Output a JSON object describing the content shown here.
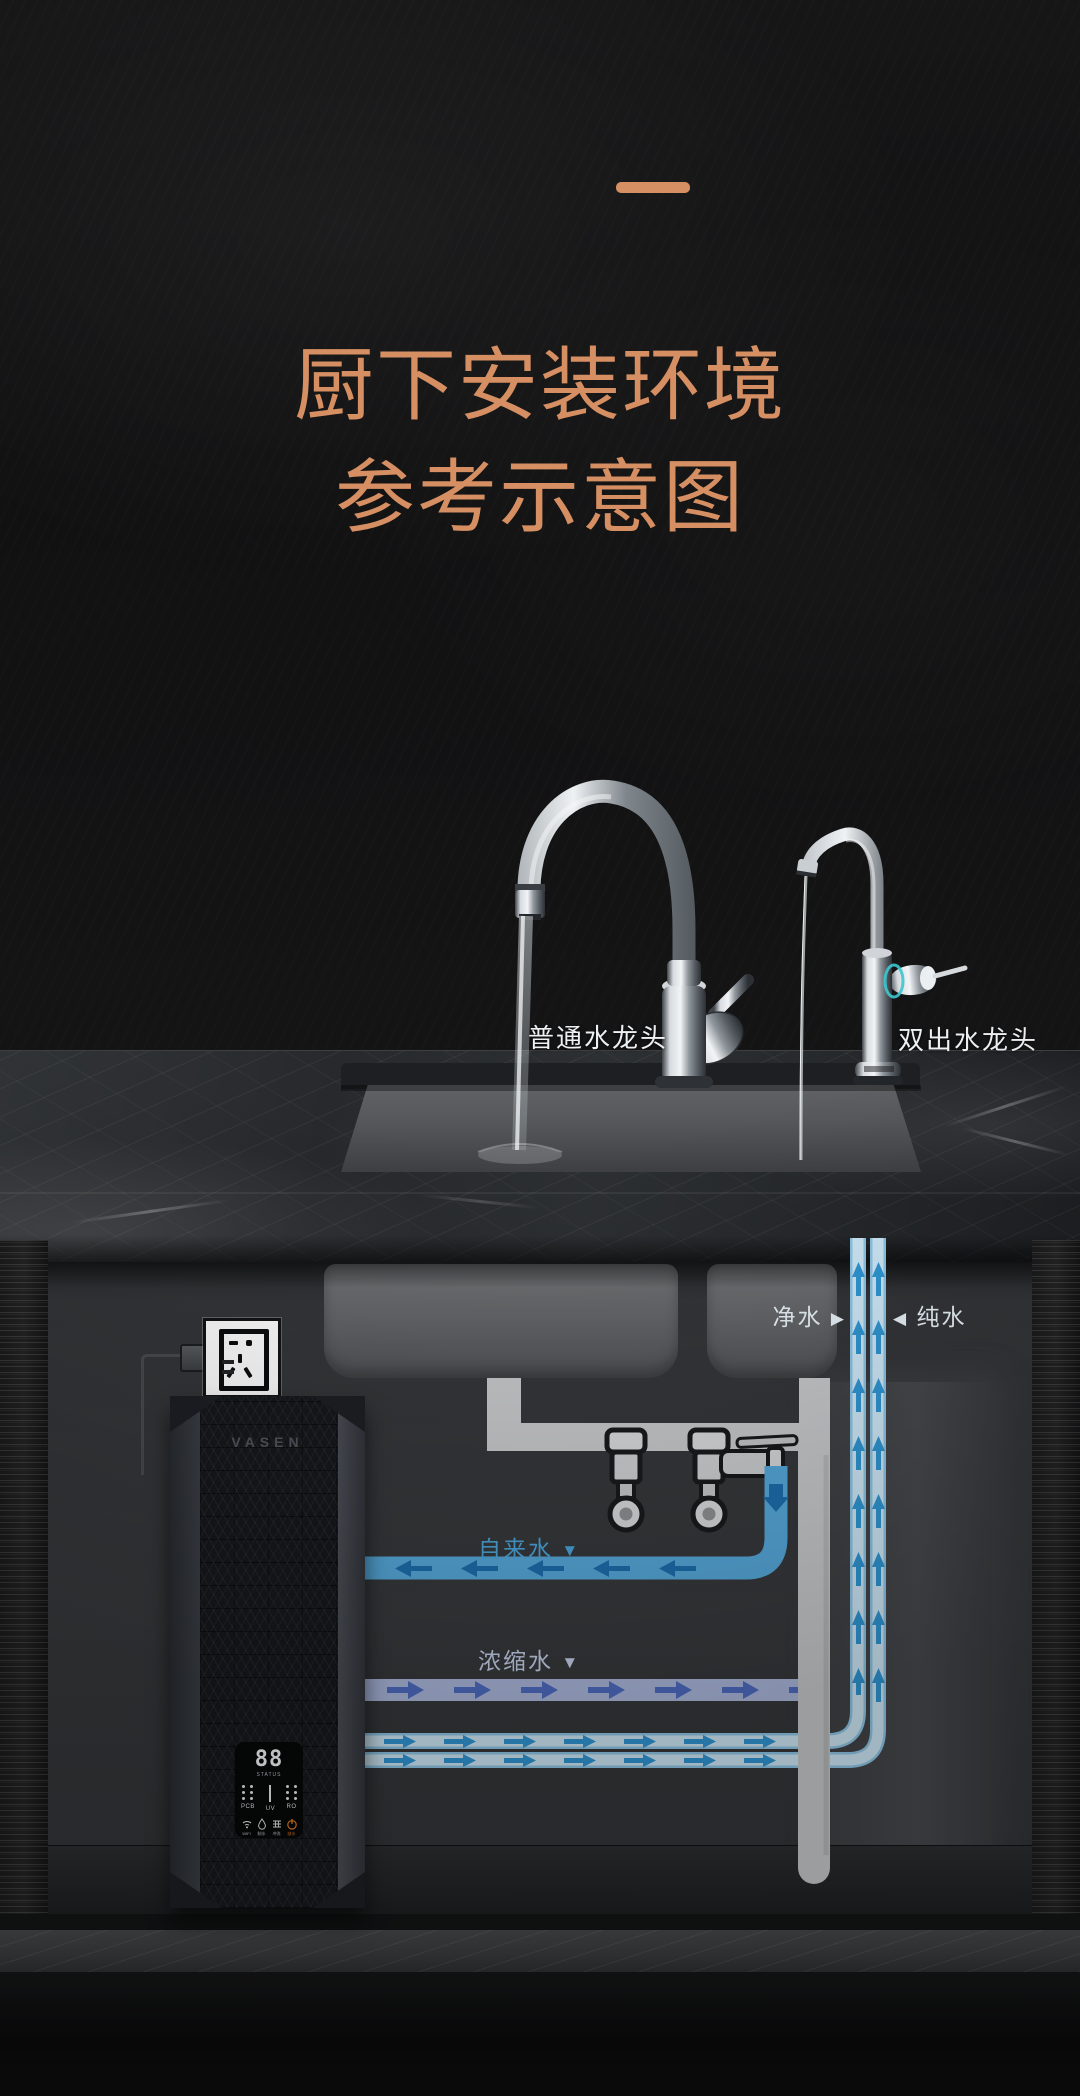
{
  "header": {
    "title_line1": "厨下安装环境",
    "title_line2": "参考示意图",
    "accent_color": "#d68f62"
  },
  "scene": {
    "left_faucet_label": "普通水龙头",
    "right_faucet_label": "双出水龙头"
  },
  "diagram": {
    "flow_labels": {
      "purified": "净水",
      "purified_arrow": "▶",
      "pure": "纯水",
      "pure_arrow": "◀",
      "tap": "自来水",
      "tap_arrow": "▼",
      "concentrate": "浓缩水",
      "concentrate_arrow": "▼"
    },
    "purifier": {
      "brand": "VASEN",
      "display": {
        "digits": "88",
        "caption": "STATUS",
        "indicators": [
          "PCB",
          "UV",
          "RO"
        ],
        "status": [
          {
            "icon": "wifi-icon",
            "label": "WIFI"
          },
          {
            "icon": "water-drop-icon",
            "label": "制水"
          },
          {
            "icon": "filter-icon",
            "label": "冲洗"
          },
          {
            "icon": "alarm-icon",
            "label": "缺水"
          }
        ]
      }
    },
    "colors": {
      "tap_pipe": "#56a9db",
      "concentrate_pipe": "#abb8dd",
      "pure_pipe": "#cfe9f8",
      "tap_arrow": "#1d6fae",
      "concentrate_arrow": "#4f6dc2",
      "pure_arrow": "#2f97d4",
      "alarm": "#e07a1e",
      "faucet_accent": "#3cc7cf"
    }
  }
}
